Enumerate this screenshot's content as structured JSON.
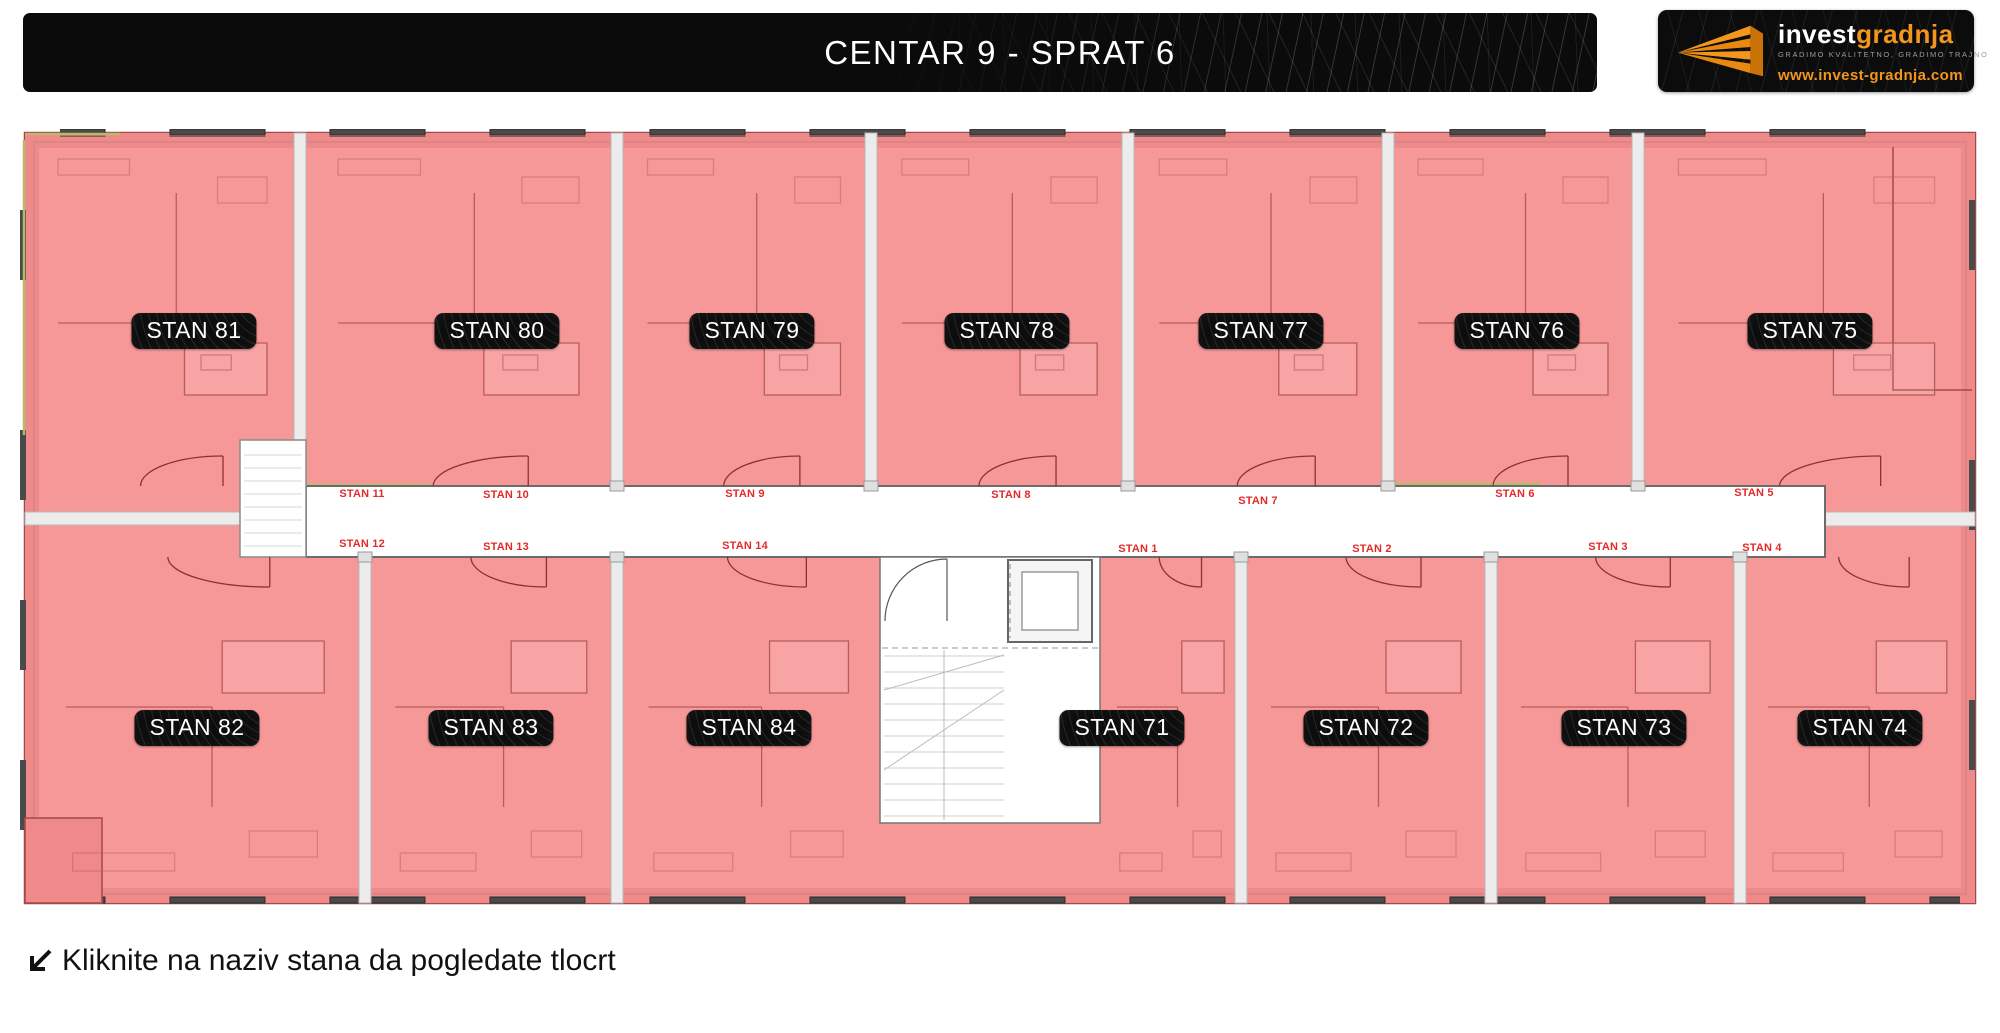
{
  "header": {
    "title": "CENTAR 9 - SPRAT 6"
  },
  "logo": {
    "name_white": "invest",
    "name_orange": "gradnja",
    "tagline": "GRADIMO KVALITETNO, GRADIMO TRAJNO",
    "website": "www.invest-gradnja.com"
  },
  "apartments": [
    {
      "label": "STAN 81",
      "x": 194,
      "y": 331
    },
    {
      "label": "STAN 80",
      "x": 497,
      "y": 331
    },
    {
      "label": "STAN 79",
      "x": 752,
      "y": 331
    },
    {
      "label": "STAN 78",
      "x": 1007,
      "y": 331
    },
    {
      "label": "STAN 77",
      "x": 1261,
      "y": 331
    },
    {
      "label": "STAN 76",
      "x": 1517,
      "y": 331
    },
    {
      "label": "STAN 75",
      "x": 1810,
      "y": 331
    },
    {
      "label": "STAN 82",
      "x": 197,
      "y": 728
    },
    {
      "label": "STAN 83",
      "x": 491,
      "y": 728
    },
    {
      "label": "STAN 84",
      "x": 749,
      "y": 728
    },
    {
      "label": "STAN 71",
      "x": 1122,
      "y": 728
    },
    {
      "label": "STAN 72",
      "x": 1366,
      "y": 728
    },
    {
      "label": "STAN 73",
      "x": 1624,
      "y": 728
    },
    {
      "label": "STAN 74",
      "x": 1860,
      "y": 728
    }
  ],
  "corridor_labels": [
    {
      "label": "STAN 11",
      "x": 362,
      "y": 494
    },
    {
      "label": "STAN 10",
      "x": 506,
      "y": 495
    },
    {
      "label": "STAN 9",
      "x": 745,
      "y": 494
    },
    {
      "label": "STAN 8",
      "x": 1011,
      "y": 495
    },
    {
      "label": "STAN 7",
      "x": 1258,
      "y": 501
    },
    {
      "label": "STAN 6",
      "x": 1515,
      "y": 494
    },
    {
      "label": "STAN 5",
      "x": 1754,
      "y": 493
    },
    {
      "label": "STAN 12",
      "x": 362,
      "y": 544
    },
    {
      "label": "STAN 13",
      "x": 506,
      "y": 547
    },
    {
      "label": "STAN 14",
      "x": 745,
      "y": 546
    },
    {
      "label": "STAN 1",
      "x": 1138,
      "y": 549
    },
    {
      "label": "STAN 2",
      "x": 1372,
      "y": 549
    },
    {
      "label": "STAN 3",
      "x": 1608,
      "y": 547
    },
    {
      "label": "STAN 4",
      "x": 1762,
      "y": 548
    }
  ],
  "footer": {
    "instruction": "Kliknite na naziv stana da pogledate tlocrt"
  },
  "colors": {
    "apartment_fill": "#f79898",
    "wall_stroke": "#a34848",
    "label_bg": "#0d0d0d",
    "label_text": "#ffffff",
    "corridor_text": "#e22a2a",
    "accent_orange": "#f2961e",
    "header_bg": "#0b0b0b"
  }
}
